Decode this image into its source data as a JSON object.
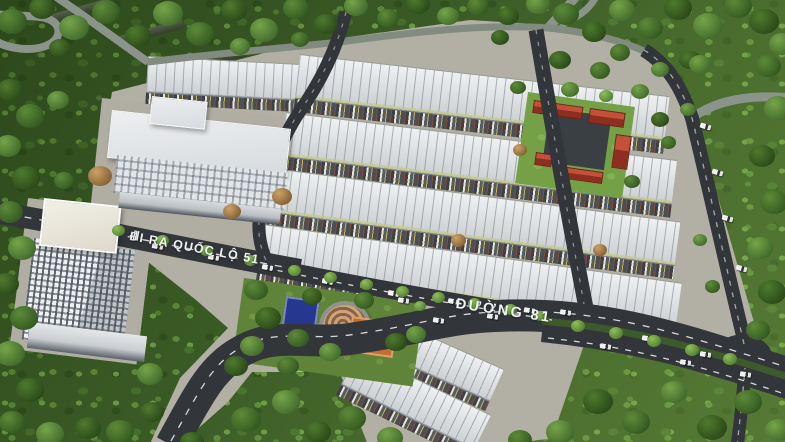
{
  "scene": {
    "title": "Aerial 3D masterplan render of a residential estate with rowhouses, towers, park and labeled roads",
    "road_labels": {
      "exit_marks": "|||",
      "exit_road": "ĐI RA QUỐC LỘ 51",
      "main_road": "ĐƯỜNG 81"
    },
    "palette": {
      "forest_green": "#3a5a25",
      "asphalt": "#32363b",
      "rowhouse_roof": "#e2e4e6",
      "ground": "#b2afa4",
      "school_red_roof": "#a83a28",
      "school_lawn": "#74a046",
      "court_blue": "#26378f",
      "court_orange": "#c4702c",
      "spiral_plaza_tan": "#b08a5f",
      "label_white": "#f1f2f3"
    }
  }
}
